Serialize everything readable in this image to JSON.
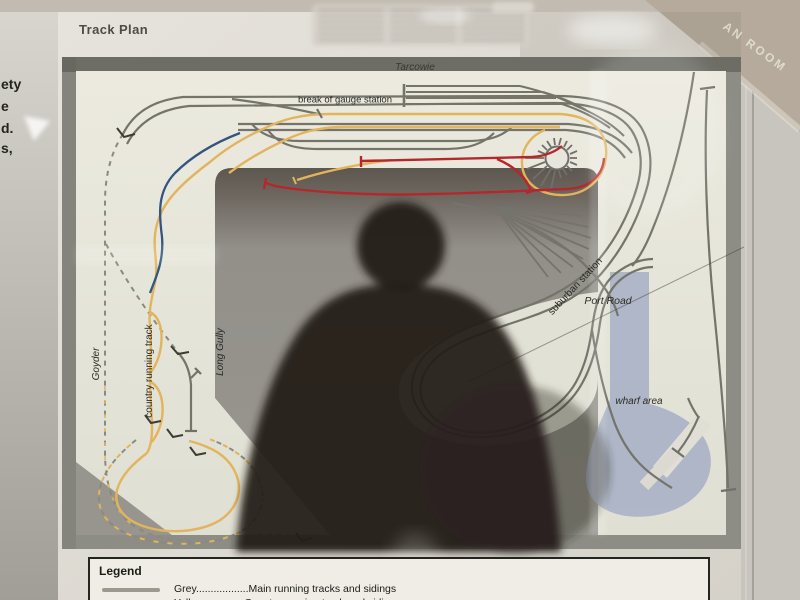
{
  "page": {
    "title": "Track Plan"
  },
  "side_panel_fragments": {
    "line1": "ety",
    "line2": "e",
    "line3": "d.",
    "line4": "s,"
  },
  "glass_reflection_text": "AN ROOM",
  "plan_labels": {
    "tarcowie": "Tarcowie",
    "break_of_gauge": "break of gauge station",
    "suburban_station": "suburban station",
    "port_road": "Port Road",
    "wharf_area": "wharf area",
    "goyder": "Goyder",
    "country_running_track": "country running track",
    "long_gully": "Long Gully"
  },
  "legend": {
    "title": "Legend",
    "rows": [
      {
        "name": "Grey",
        "swatch_color": "#9a9a8e",
        "text": "Grey..................Main running tracks and sidings"
      },
      {
        "name": "Yellow",
        "swatch_color": "#eac878",
        "text": "Yellow..............Country running track and sidings"
      }
    ]
  },
  "track_colors": {
    "main_grey": "#74746b",
    "country_yellow": "#e2b45c",
    "red": "#b5272b",
    "blue": "#33557f",
    "hidden_dashed": "#8a8a80",
    "water_blue": "#aab3c7"
  }
}
